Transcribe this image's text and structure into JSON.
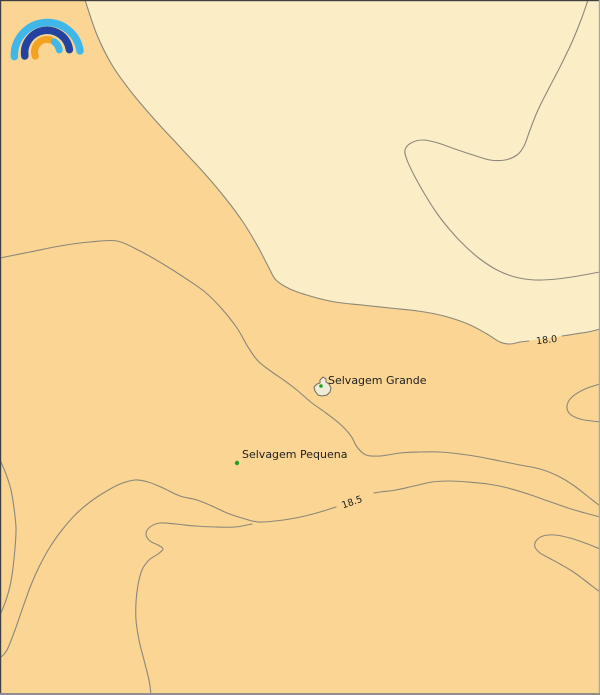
{
  "map": {
    "islands": [
      {
        "name": "Selvagem Grande"
      },
      {
        "name": "Selvagem Pequena"
      }
    ],
    "contours": [
      {
        "label": "18.0"
      },
      {
        "label": "18.5"
      }
    ]
  },
  "icons": {
    "logo": "rainbow-arcs-weather-logo"
  },
  "colors": {
    "sea_warm": "#fad594",
    "sea_cool": "#fbeec7",
    "contour_line": "#8c8779",
    "label_text": "#1e1e1e",
    "island_fill": "#efecd7",
    "island_outline": "#6e6c5d",
    "station_dot": "#23a127",
    "logo_light_blue": "#3fb7e8",
    "logo_dark_blue": "#2442a0",
    "logo_orange": "#f4a21f",
    "border_dark": "#3f3f3f",
    "border_right": "#a8a8a2",
    "border_bottom": "#8f8f8a"
  }
}
